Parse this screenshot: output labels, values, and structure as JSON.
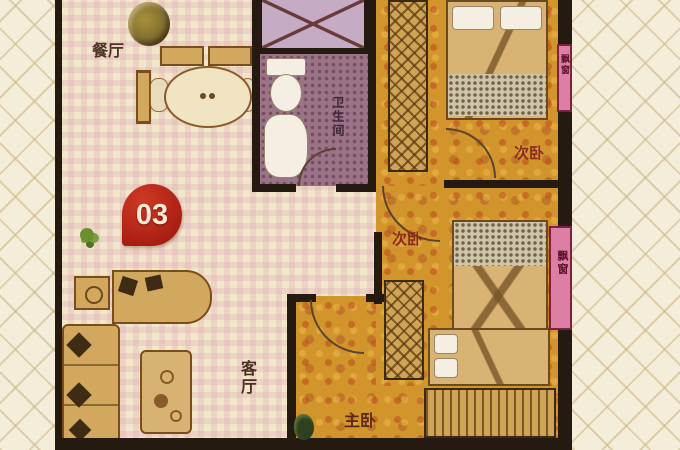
{
  "floorplan": {
    "unit_badge": "03",
    "rooms": {
      "dining": {
        "label": "餐厅"
      },
      "bathroom": {
        "label": "卫生间"
      },
      "bedroom_top": {
        "label": "次卧"
      },
      "bedroom_mid": {
        "label": "次卧"
      },
      "living": {
        "label": "客厅"
      },
      "master": {
        "label": "主卧"
      },
      "bay_top": {
        "label": "飘窗"
      },
      "bay_bottom": {
        "label": "飘窗"
      }
    },
    "colors": {
      "wall": "#241a10",
      "floor_cream": "#f2e6cb",
      "floor_orange": "#d2952c",
      "bathroom_mauve": "#9b7387",
      "shaft_lavender": "#c6abc4",
      "badge_red": "#b5231a",
      "furniture_tan": "#d2a85f",
      "bay_pink": "#dd7fa4"
    }
  }
}
